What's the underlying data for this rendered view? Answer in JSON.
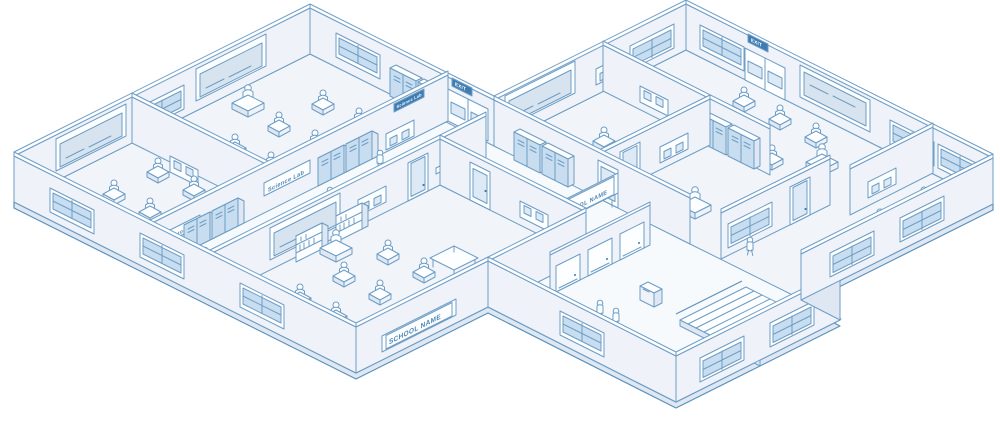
{
  "illustration": {
    "signs": {
      "school_name": "SCHOOL NAME",
      "exit": "EXIT",
      "science_lab": "Science Lab",
      "classroom": "Classroom"
    },
    "colors": {
      "line": "#6D9DC5",
      "accent": "#3E7CB2",
      "sign_text": "#4E86B3",
      "plate_text": "#FFFFFF",
      "wall_fill": "#EFF3F9",
      "floor_fill": "#F1F4F9",
      "corridor_fill": "#F7FAFD",
      "glass": "#C8DEF0",
      "shade": "#DFE8F2"
    },
    "elements": [
      "classroom",
      "science-lab",
      "corridor",
      "hall",
      "lockers",
      "blackboard",
      "bulletin-board",
      "student-desk",
      "teacher-desk",
      "bookshelf",
      "table",
      "stairs",
      "restroom-stalls",
      "copier",
      "window",
      "door",
      "exit-door",
      "people"
    ]
  }
}
